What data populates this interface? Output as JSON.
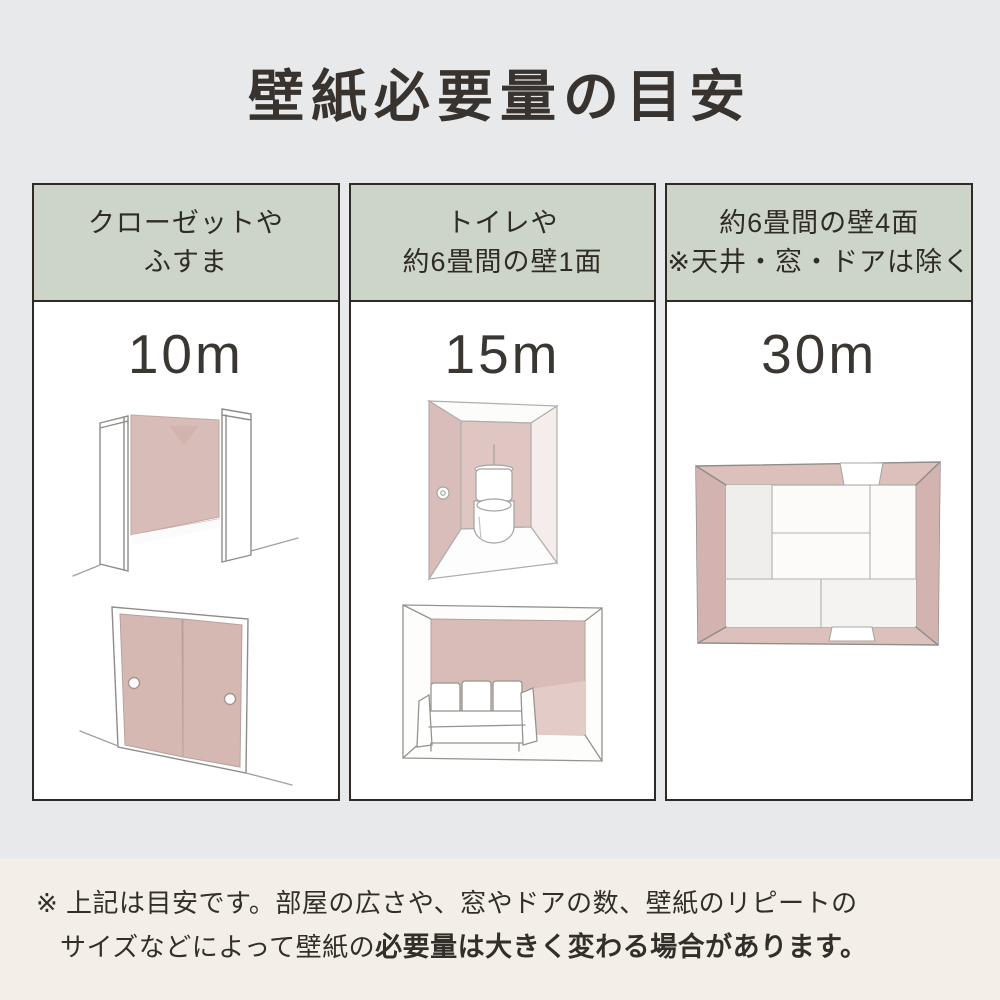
{
  "title": "壁紙必要量の目安",
  "colors": {
    "page_background": "#e8e9ea",
    "header_green": "#cdd5c8",
    "card_border": "#2d2a27",
    "wall_pink": "#d7b9b4",
    "footer_cream": "#f3efe7",
    "text_dark": "#38342f"
  },
  "columns": [
    {
      "header_line1": "クローゼットや",
      "header_line2": "ふすま",
      "value": "10m",
      "illustrations": [
        "closet",
        "fusuma-sliding-doors"
      ]
    },
    {
      "header_line1": "トイレや",
      "header_line2": "約6畳間の壁1面",
      "value": "15m",
      "illustrations": [
        "toilet-room",
        "room-with-sofa"
      ]
    },
    {
      "header_line1": "約6畳間の壁4面",
      "header_line2": "※天井・窓・ドアは除く",
      "value": "30m",
      "illustrations": [
        "six-tatami-room-top-view"
      ]
    }
  ],
  "footnote": {
    "line1": "※ 上記は目安です。部屋の広さや、窓やドアの数、壁紙のリピートの",
    "line2_regular": "サイズなどによって壁紙の",
    "line2_bold": "必要量は大きく変わる場合があります。"
  }
}
